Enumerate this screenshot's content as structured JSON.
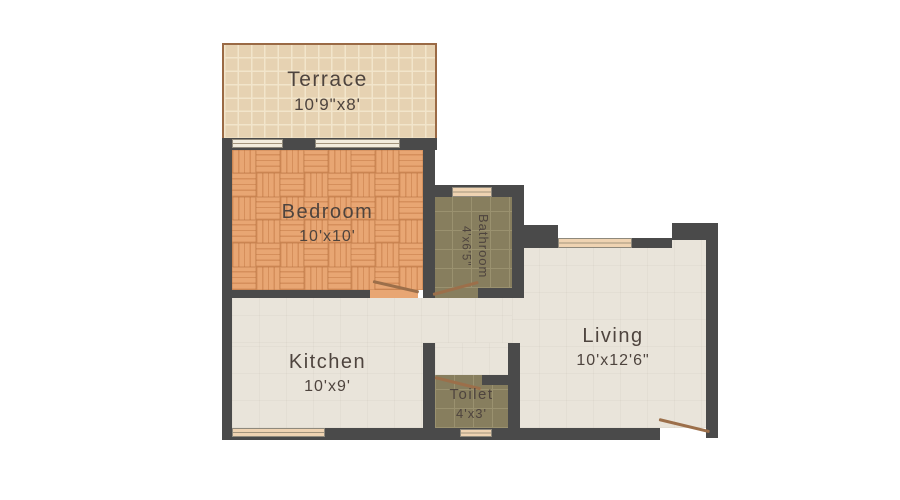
{
  "plan_title": "1 BHK Floor Plan",
  "rooms": {
    "terrace": {
      "name": "Terrace",
      "dims": "10'9\"x8'"
    },
    "bedroom": {
      "name": "Bedroom",
      "dims": "10'x10'"
    },
    "bathroom": {
      "name": "Bathroom",
      "dims": "4'x6'5\""
    },
    "living": {
      "name": "Living",
      "dims": "10'x12'6\""
    },
    "kitchen": {
      "name": "Kitchen",
      "dims": "10'x9'"
    },
    "toilet": {
      "name": "Toilet",
      "dims": "4'x3'"
    }
  },
  "colors": {
    "wall": "#4a4a4a",
    "terraceTile": "#e6d2b2",
    "terraceGrout": "#f2e5cb",
    "terraceEdge": "#9a6a45",
    "parquetBase": "#e8a673",
    "parquetStripe": "rgba(198,124,72,0.55)",
    "oliveTile": "#877e5e",
    "oliveGrout": "#9a916f",
    "floorLight": "#e9e4da",
    "windowFill": "#efd3b2",
    "windowLight": "#f2ecdd",
    "doorLine": "#9c6f4a",
    "labelColor": "#4e443e"
  },
  "icons": {
    "door_swing": "diagonal-door-leaf-line",
    "window": "sill-band-with-midline"
  }
}
